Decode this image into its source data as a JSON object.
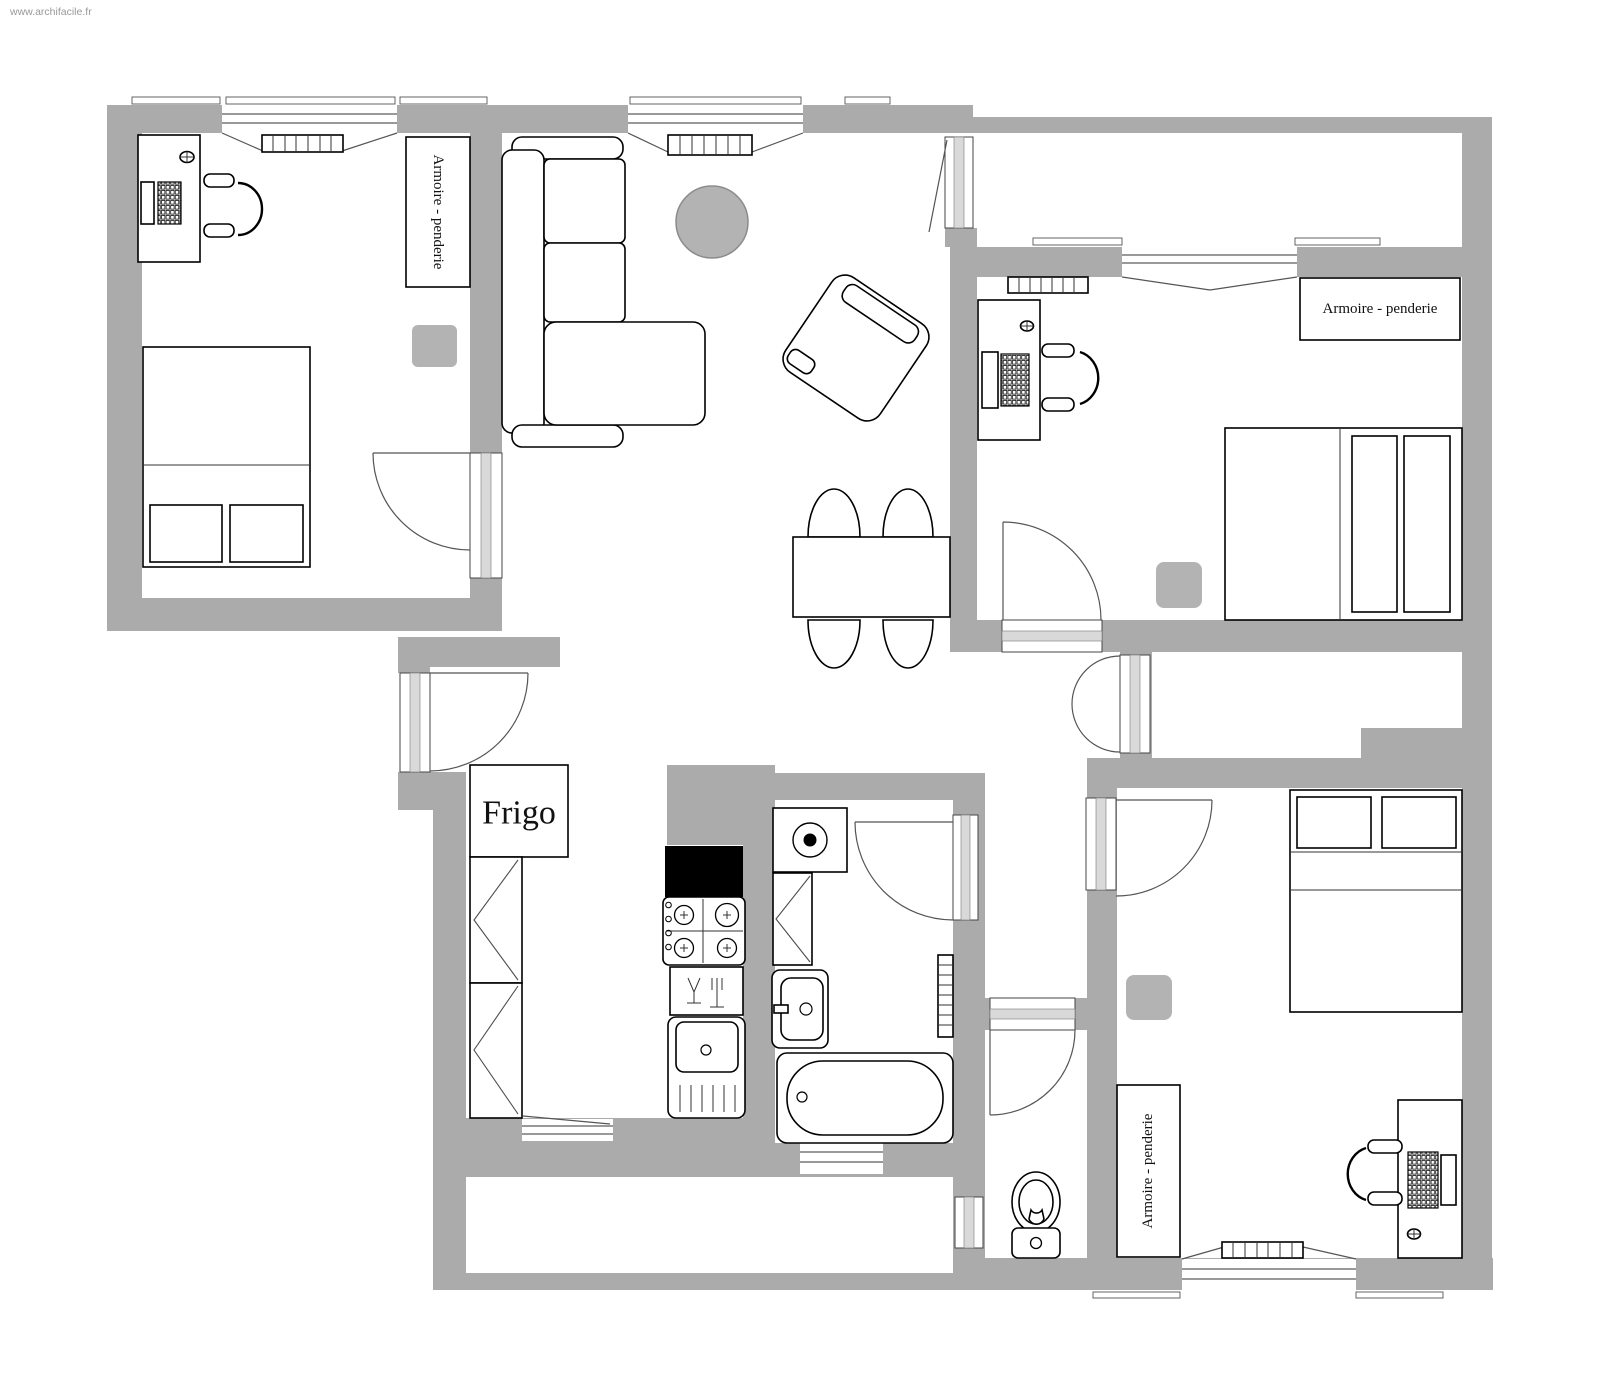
{
  "watermark": "www.archifacile.fr",
  "labels": {
    "wardrobe": "Armoire - penderie",
    "fridge": "Frigo"
  },
  "colors": {
    "wall": "#ABABAB",
    "background": "#FFFFFF",
    "outline": "#000000",
    "door_arc": "#555555",
    "gray_furniture": "#B3B3B3",
    "hood": "#000000",
    "watermark_text": "#999999"
  }
}
